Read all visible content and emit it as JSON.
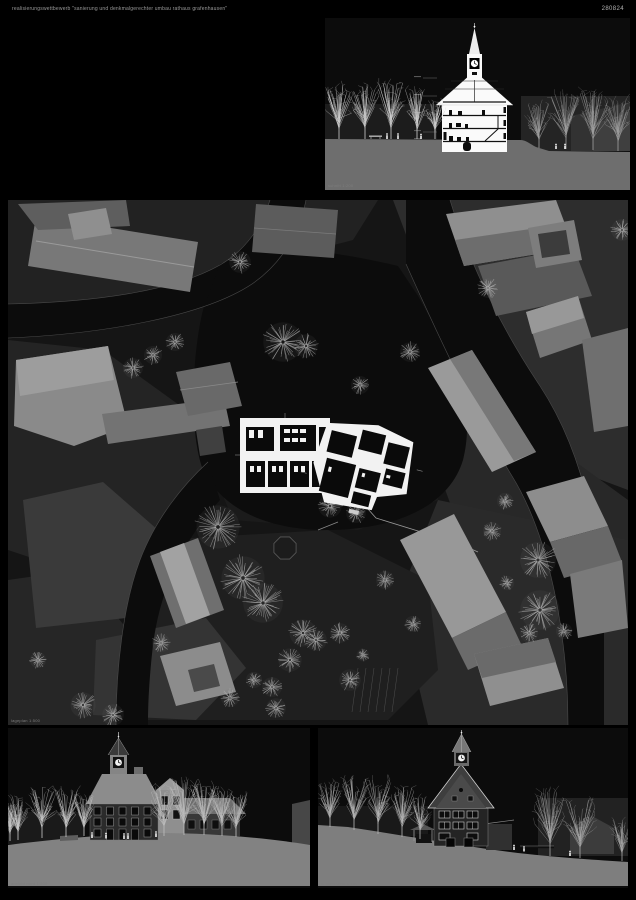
{
  "header": {
    "title": "realisierungswettbewerb \"sanierung und denkmalgerechter umbau rathaus grafenhausen\"",
    "entry_number": "280824"
  },
  "panels": {
    "section": {
      "caption": "schnitt 1:200"
    },
    "site_plan": {
      "caption": "lageplan 1:500"
    },
    "elevation_south": {
      "caption": "ansicht nord 1:200"
    },
    "elevation_west": {
      "caption": "ansicht west 1:200"
    }
  },
  "colors": {
    "background": "#000000",
    "panel_background": "#0c0c0c",
    "plan_background": "#151515",
    "road_dark": "#0c0c0c",
    "parcel_gray": "#2a2a2a",
    "building_gray": "#8a8a8a",
    "drawing_white": "#f2f2f2",
    "ground_gray": "#7e7e7e",
    "tree_gray": "#bdbdbd",
    "caption_gray": "#7d7d7d"
  }
}
